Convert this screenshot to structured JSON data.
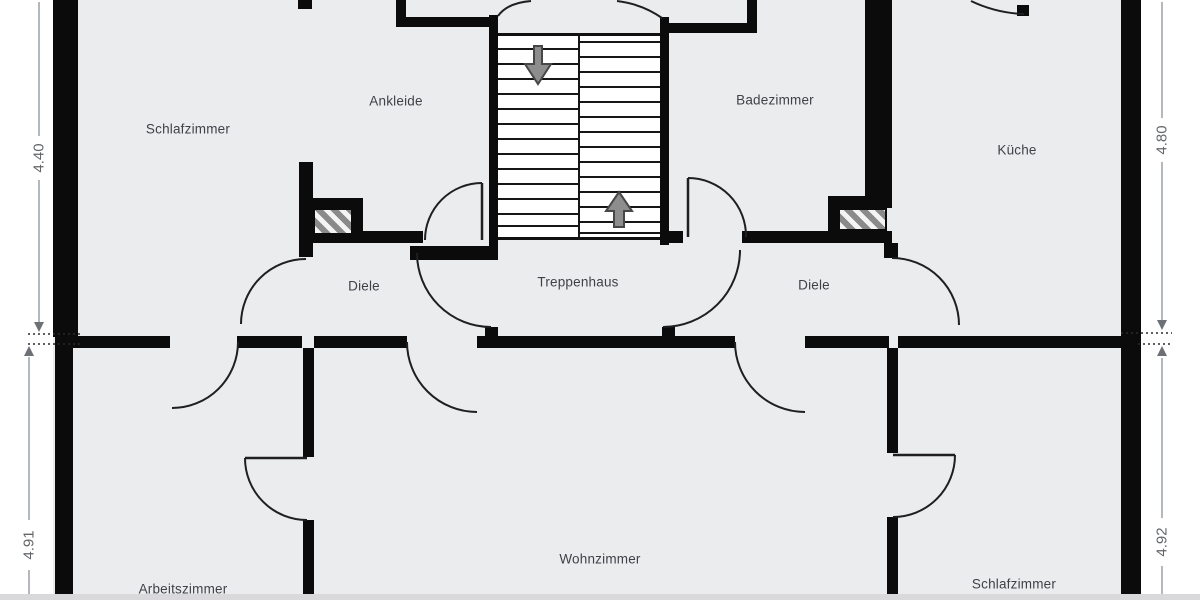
{
  "title": "Floor plan – upper storey (German room labels)",
  "colors": {
    "wall": "#0b0b0b",
    "room_fill": "#ebecee",
    "background": "#ffffff",
    "stair_fill": "#ffffff",
    "door_arc": "#1f1f1f",
    "arrow_fill": "#8d8d8d",
    "arrow_stroke": "#474747",
    "dim_line": "#9aa0a6",
    "dim_text": "#63666a",
    "label_text": "#3e4247"
  },
  "rooms": [
    {
      "id": "schlafzimmer-top",
      "label": "Schlafzimmer",
      "x": 188,
      "y": 129
    },
    {
      "id": "ankleide",
      "label": "Ankleide",
      "x": 396,
      "y": 101
    },
    {
      "id": "badezimmer",
      "label": "Badezimmer",
      "x": 775,
      "y": 100
    },
    {
      "id": "kueche",
      "label": "Küche",
      "x": 1017,
      "y": 150
    },
    {
      "id": "diele-left",
      "label": "Diele",
      "x": 364,
      "y": 286
    },
    {
      "id": "treppenhaus",
      "label": "Treppenhaus",
      "x": 578,
      "y": 282
    },
    {
      "id": "diele-right",
      "label": "Diele",
      "x": 814,
      "y": 285
    },
    {
      "id": "arbeitszimmer",
      "label": "Arbeitszimmer",
      "x": 183,
      "y": 589
    },
    {
      "id": "wohnzimmer",
      "label": "Wohnzimmer",
      "x": 600,
      "y": 559
    },
    {
      "id": "schlafzimmer-bottom",
      "label": "Schlafzimmer",
      "x": 1014,
      "y": 584
    }
  ],
  "dimensions": [
    {
      "id": "dim-left-upper",
      "label": "4.40",
      "x": 39,
      "y": 158
    },
    {
      "id": "dim-left-lower",
      "label": "4.91",
      "x": 29,
      "y": 545
    },
    {
      "id": "dim-right-upper",
      "label": "4.80",
      "x": 1162,
      "y": 140
    },
    {
      "id": "dim-right-lower",
      "label": "4.92",
      "x": 1162,
      "y": 542
    }
  ],
  "walls": [
    {
      "id": "exterior-left-upper",
      "x": 53,
      "y": 0,
      "w": 25,
      "h": 337
    },
    {
      "id": "exterior-left-lower",
      "x": 55,
      "y": 337,
      "w": 18,
      "h": 263
    },
    {
      "id": "exterior-right",
      "x": 1121,
      "y": 0,
      "w": 20,
      "h": 600
    },
    {
      "id": "schlaf-ankleide-stub-top",
      "x": 298,
      "y": 0,
      "w": 14,
      "h": 9
    },
    {
      "id": "ankleide-corner-vertical",
      "x": 396,
      "y": 0,
      "w": 10,
      "h": 27
    },
    {
      "id": "ankleide-corner-horizontal",
      "x": 396,
      "y": 17,
      "w": 98,
      "h": 10
    },
    {
      "id": "stair-left-wall",
      "x": 489,
      "y": 15,
      "w": 9,
      "h": 235
    },
    {
      "id": "stair-right-wall",
      "x": 660,
      "y": 17,
      "w": 9,
      "h": 228
    },
    {
      "id": "badezimmer-corner-horizontal",
      "x": 660,
      "y": 23,
      "w": 97,
      "h": 10
    },
    {
      "id": "badezimmer-corner-vertical",
      "x": 747,
      "y": 0,
      "w": 10,
      "h": 33
    },
    {
      "id": "badezimmer-kueche-wall",
      "x": 865,
      "y": 0,
      "w": 27,
      "h": 208
    },
    {
      "id": "chimney-right-frame-top",
      "x": 828,
      "y": 196,
      "w": 40,
      "h": 12
    },
    {
      "id": "chimney-right-frame-left",
      "x": 828,
      "y": 196,
      "w": 10,
      "h": 35
    },
    {
      "id": "diele-right-top-wall",
      "x": 742,
      "y": 231,
      "w": 150,
      "h": 12
    },
    {
      "id": "diele-right-top-stub",
      "x": 660,
      "y": 231,
      "w": 23,
      "h": 12
    },
    {
      "id": "kueche-west-stub",
      "x": 884,
      "y": 243,
      "w": 14,
      "h": 15
    },
    {
      "id": "chimney-left-frame-top",
      "x": 310,
      "y": 198,
      "w": 53,
      "h": 12
    },
    {
      "id": "chimney-left-frame-right",
      "x": 352,
      "y": 198,
      "w": 11,
      "h": 37
    },
    {
      "id": "diele-left-top-wall",
      "x": 302,
      "y": 231,
      "w": 121,
      "h": 12
    },
    {
      "id": "stair-lower-left-wall",
      "x": 410,
      "y": 246,
      "w": 88,
      "h": 14
    },
    {
      "id": "schlafzimmer-diele-wall",
      "x": 299,
      "y": 162,
      "w": 14,
      "h": 95
    },
    {
      "id": "treppenhaus-left-stub",
      "x": 485,
      "y": 327,
      "w": 13,
      "h": 12
    },
    {
      "id": "treppenhaus-right-stub",
      "x": 662,
      "y": 327,
      "w": 13,
      "h": 12
    },
    {
      "id": "section-wall-a",
      "x": 70,
      "y": 336,
      "w": 100,
      "h": 12
    },
    {
      "id": "section-wall-b",
      "x": 237,
      "y": 336,
      "w": 65,
      "h": 12
    },
    {
      "id": "section-wall-c",
      "x": 314,
      "y": 336,
      "w": 93,
      "h": 12
    },
    {
      "id": "section-wall-d",
      "x": 477,
      "y": 336,
      "w": 258,
      "h": 12
    },
    {
      "id": "section-wall-e",
      "x": 805,
      "y": 336,
      "w": 84,
      "h": 12
    },
    {
      "id": "section-wall-f",
      "x": 898,
      "y": 336,
      "w": 223,
      "h": 12
    },
    {
      "id": "arbeits-wohn-wall-upper",
      "x": 303,
      "y": 348,
      "w": 11,
      "h": 109
    },
    {
      "id": "arbeits-wohn-wall-lower",
      "x": 303,
      "y": 520,
      "w": 11,
      "h": 80
    },
    {
      "id": "wohn-schlaf-wall-upper",
      "x": 887,
      "y": 348,
      "w": 11,
      "h": 105
    },
    {
      "id": "wohn-schlaf-wall-lower",
      "x": 887,
      "y": 517,
      "w": 11,
      "h": 83
    },
    {
      "id": "kueche-top-door-stub",
      "x": 1017,
      "y": 5,
      "w": 12,
      "h": 11
    }
  ],
  "hatches": [
    {
      "id": "chimney-left-hatch",
      "x": 313,
      "y": 208,
      "w": 40,
      "h": 27
    },
    {
      "id": "chimney-right-hatch",
      "x": 838,
      "y": 208,
      "w": 49,
      "h": 23
    }
  ],
  "stairs": {
    "x": 498,
    "y": 33,
    "w": 162,
    "h": 207,
    "divider_x": 578,
    "left_steps_y": [
      48,
      63,
      78,
      93,
      108,
      123,
      138,
      153,
      168,
      183,
      198,
      213,
      225
    ],
    "right_steps_y": [
      41,
      56,
      71,
      86,
      101,
      116,
      131,
      146,
      161,
      176,
      191,
      206,
      221,
      232
    ]
  },
  "door_leaves": [
    {
      "id": "ankleide-door-leaf",
      "d": "M 482 183 L 482 240"
    },
    {
      "id": "badezimmer-door-leaf",
      "d": "M 688 178 L 688 237"
    },
    {
      "id": "arbeits-wohn-door-leaf",
      "d": "M 245 458 L 307 458"
    },
    {
      "id": "wohn-schlaf-door-leaf",
      "d": "M 893 455 L 955 455"
    }
  ],
  "door_arcs": [
    {
      "id": "ankleide-top-door-arc",
      "d": "M 498 16 Q 507 3 531 1"
    },
    {
      "id": "badezimmer-top-door-arc",
      "d": "M 662 18 Q 642 4 617 1"
    },
    {
      "id": "kueche-top-door-arc",
      "d": "M 1024 14 Q 996 13 971 1"
    },
    {
      "id": "ankleide-door-arc",
      "d": "M 425 240 A 57 57 0 0 1 482 183"
    },
    {
      "id": "badezimmer-door-arc",
      "d": "M 688 178 A 58 58 0 0 1 746 237"
    },
    {
      "id": "schlafzimmer-diele-door-arc",
      "d": "M 241 324 A 65 65 0 0 1 306 259"
    },
    {
      "id": "treppenhaus-left-door-arc",
      "d": "M 417 253 A 74 74 0 0 0 491 327"
    },
    {
      "id": "treppenhaus-right-door-arc",
      "d": "M 740 250 A 77 77 0 0 1 663 327"
    },
    {
      "id": "kueche-door-arc",
      "d": "M 892 258 A 67 67 0 0 1 959 325"
    },
    {
      "id": "arbeitszimmer-door-arc",
      "d": "M 238 342 A 66 66 0 0 1 172 408"
    },
    {
      "id": "wohnzimmer-left-door-arc",
      "d": "M 407 342 A 70 70 0 0 0 477 412"
    },
    {
      "id": "wohnzimmer-right-door-arc",
      "d": "M 735 342 A 70 70 0 0 0 805 412"
    },
    {
      "id": "arbeits-wohn-door-arc",
      "d": "M 245 458 A 62 62 0 0 0 307 520"
    },
    {
      "id": "wohn-schlaf-door-arc",
      "d": "M 955 455 A 62 62 0 0 1 893 517"
    }
  ],
  "stair_arrows": [
    {
      "id": "stair-arrow-down-icon",
      "points": "534,46 542,46 542,64 551,64 538,84 525,64 534,64"
    },
    {
      "id": "stair-arrow-up-icon",
      "points": "619,192 632,211 624,211 624,227 614,227 614,211 606,211"
    }
  ],
  "dim_lines": [
    {
      "id": "dim-440-line-a",
      "x1": 39,
      "y1": 2,
      "x2": 39,
      "y2": 136
    },
    {
      "id": "dim-440-line-b",
      "x1": 39,
      "y1": 180,
      "x2": 39,
      "y2": 322
    },
    {
      "id": "dim-491-line-a",
      "x1": 29,
      "y1": 357,
      "x2": 29,
      "y2": 520
    },
    {
      "id": "dim-491-line-b",
      "x1": 29,
      "y1": 570,
      "x2": 29,
      "y2": 598
    },
    {
      "id": "dim-480-line-a",
      "x1": 1162,
      "y1": 2,
      "x2": 1162,
      "y2": 118
    },
    {
      "id": "dim-480-line-b",
      "x1": 1162,
      "y1": 162,
      "x2": 1162,
      "y2": 320
    },
    {
      "id": "dim-492-line-a",
      "x1": 1162,
      "y1": 358,
      "x2": 1162,
      "y2": 518
    },
    {
      "id": "dim-492-line-b",
      "x1": 1162,
      "y1": 566,
      "x2": 1162,
      "y2": 598
    }
  ],
  "dim_dotted": [
    {
      "id": "dim-ext-left-a",
      "x1": 28,
      "y1": 334,
      "x2": 80,
      "y2": 334
    },
    {
      "id": "dim-ext-left-b",
      "x1": 28,
      "y1": 344,
      "x2": 80,
      "y2": 344
    },
    {
      "id": "dim-ext-right-a",
      "x1": 1121,
      "y1": 333,
      "x2": 1172,
      "y2": 333
    },
    {
      "id": "dim-ext-right-b",
      "x1": 1138,
      "y1": 344,
      "x2": 1172,
      "y2": 344
    }
  ],
  "dim_arrowheads": [
    {
      "id": "dim-440-arrow-down",
      "points": "39,332 34,322 44,322"
    },
    {
      "id": "dim-491-arrow-up",
      "points": "29,346 24,356 34,356"
    },
    {
      "id": "dim-480-arrow-down",
      "points": "1162,330 1157,320 1167,320"
    },
    {
      "id": "dim-492-arrow-up",
      "points": "1162,346 1157,356 1167,356"
    }
  ]
}
